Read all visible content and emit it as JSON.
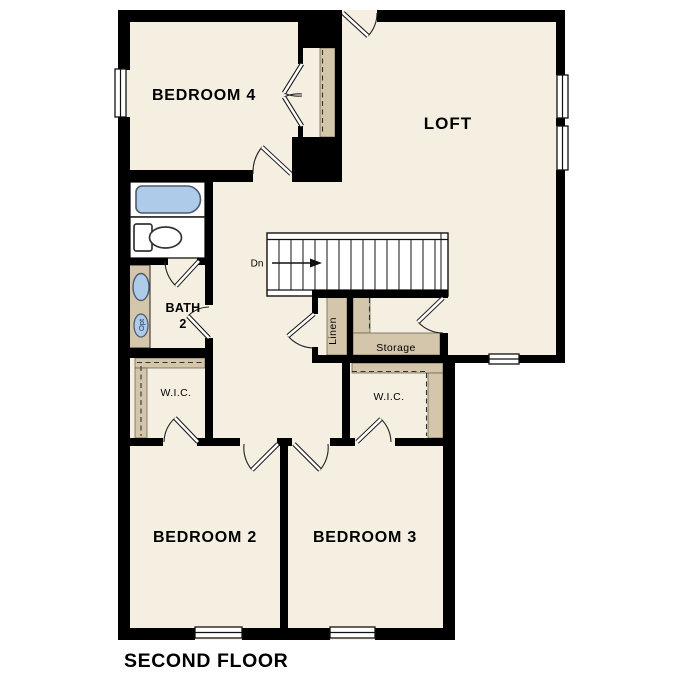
{
  "title": "SECOND FLOOR",
  "rooms": {
    "bedroom4": "BEDROOM 4",
    "loft": "LOFT",
    "bedroom2": "BEDROOM 2",
    "bedroom3": "BEDROOM 3",
    "bath": {
      "line1": "BATH",
      "line2": "2"
    },
    "wic_left": "W.I.C.",
    "wic_right": "W.I.C.",
    "linen": "Linen",
    "storage": "Storage"
  },
  "stairs": {
    "down_label": "Dn"
  },
  "fixtures": {
    "optional_sink_label": "Opt"
  },
  "colors": {
    "floor": "#f5efe2",
    "wall": "#000000",
    "shelf_tan": "#d3c6ab",
    "fixture_blue": "#aecbea",
    "outside": "#ffffff"
  }
}
